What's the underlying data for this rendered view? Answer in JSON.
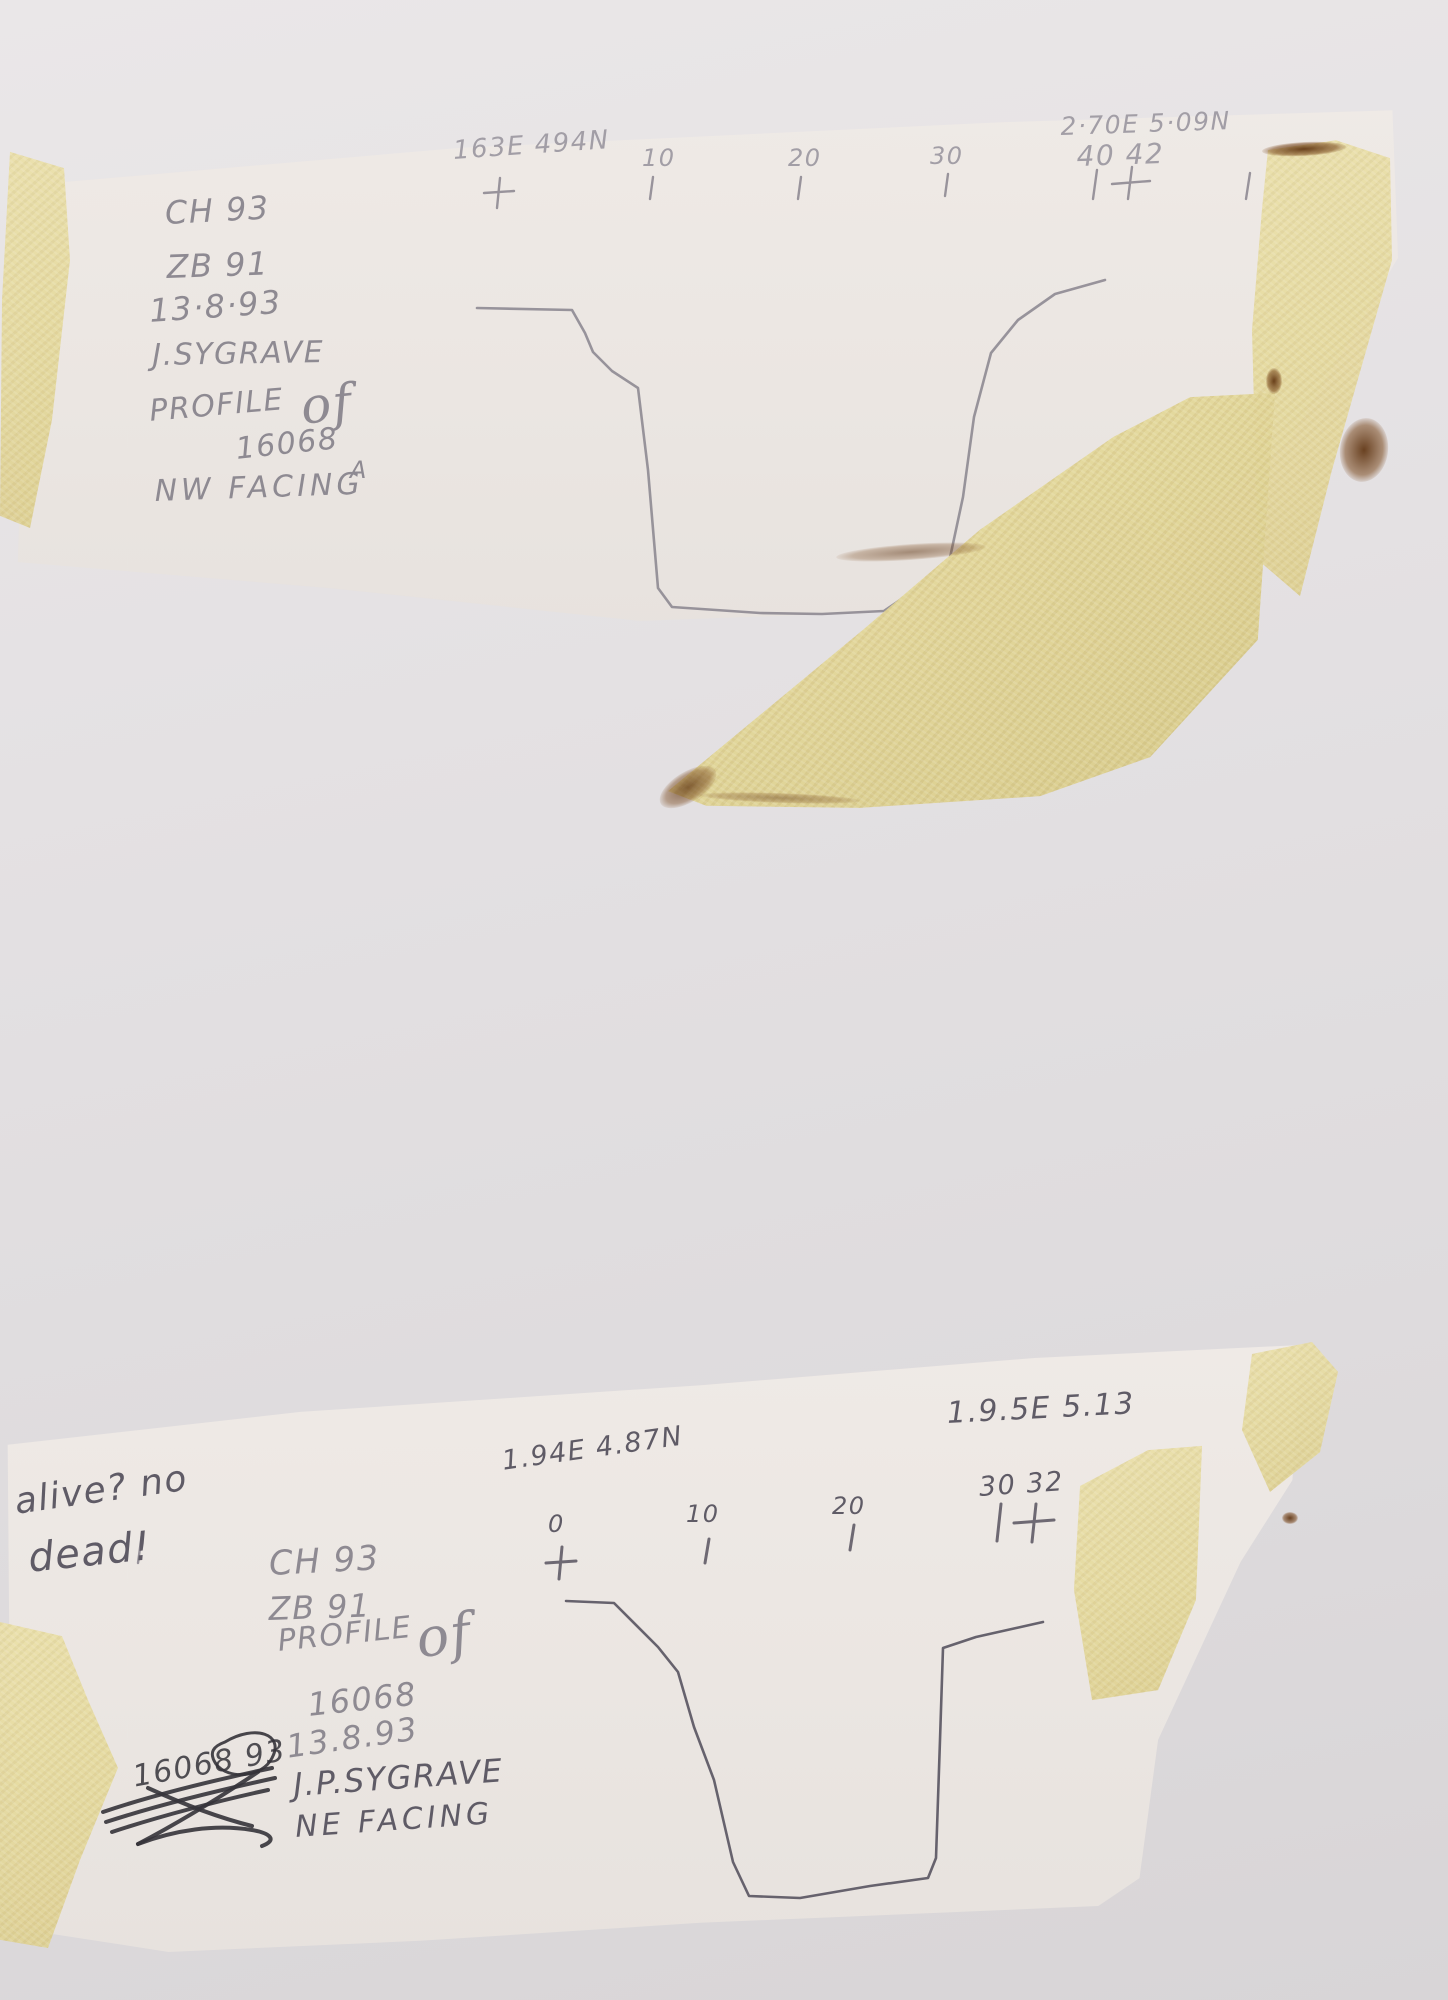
{
  "colors": {
    "backing": "#e2dfe1",
    "sheet": "#ece7e3",
    "tape": "#e7dca6",
    "pencil": "#8e8a92",
    "pencil_light": "#a29ea6",
    "pencil_dark": "#5f5b66",
    "ink_dark": "#35333a"
  },
  "sheet_top": {
    "datum_left": "163E 494N",
    "datum_right": "2·70E 5·09N",
    "ticks": {
      "t10": "10",
      "t20": "20",
      "t30": "30"
    },
    "end_numbers": "40 42",
    "title_block": {
      "site": "CH 93",
      "zone": "ZB 91",
      "date": "13·8·93",
      "recorder": "J.SYGRAVE",
      "drawing": "PROFILE",
      "of": "of",
      "feature": "16068",
      "suffix": "A",
      "facing": "NW FACING"
    },
    "profile_points": [
      [
        477,
        308
      ],
      [
        572,
        310
      ],
      [
        585,
        333
      ],
      [
        593,
        352
      ],
      [
        612,
        371
      ],
      [
        638,
        388
      ],
      [
        648,
        470
      ],
      [
        658,
        588
      ],
      [
        672,
        607
      ],
      [
        760,
        613
      ],
      [
        822,
        614
      ],
      [
        884,
        611
      ],
      [
        948,
        567
      ],
      [
        963,
        497
      ],
      [
        974,
        417
      ],
      [
        991,
        353
      ],
      [
        1018,
        320
      ],
      [
        1055,
        294
      ],
      [
        1105,
        280
      ]
    ]
  },
  "sheet_bottom": {
    "note_line1": "alive? no",
    "note_line2": "dead!",
    "datum_left": "1.94E 4.87N",
    "datum_right": "1.9.5E 5.13",
    "ticks": {
      "t0": "0",
      "t10": "10",
      "t20": "20"
    },
    "end_numbers": "30 32",
    "title_block": {
      "site": "CH 93",
      "zone": "ZB 91",
      "drawing": "PROFILE",
      "of": "of",
      "feature": "16068",
      "date": "13.8.93",
      "recorder": "J.P.SYGRAVE",
      "facing": "NE FACING"
    },
    "crossed_out": "16068 93",
    "profile_points": [
      [
        566,
        1601
      ],
      [
        614,
        1603
      ],
      [
        658,
        1647
      ],
      [
        678,
        1672
      ],
      [
        694,
        1727
      ],
      [
        714,
        1780
      ],
      [
        733,
        1862
      ],
      [
        749,
        1896
      ],
      [
        800,
        1898
      ],
      [
        870,
        1886
      ],
      [
        928,
        1878
      ],
      [
        936,
        1858
      ],
      [
        940,
        1740
      ],
      [
        943,
        1648
      ],
      [
        976,
        1637
      ],
      [
        1043,
        1622
      ]
    ]
  }
}
